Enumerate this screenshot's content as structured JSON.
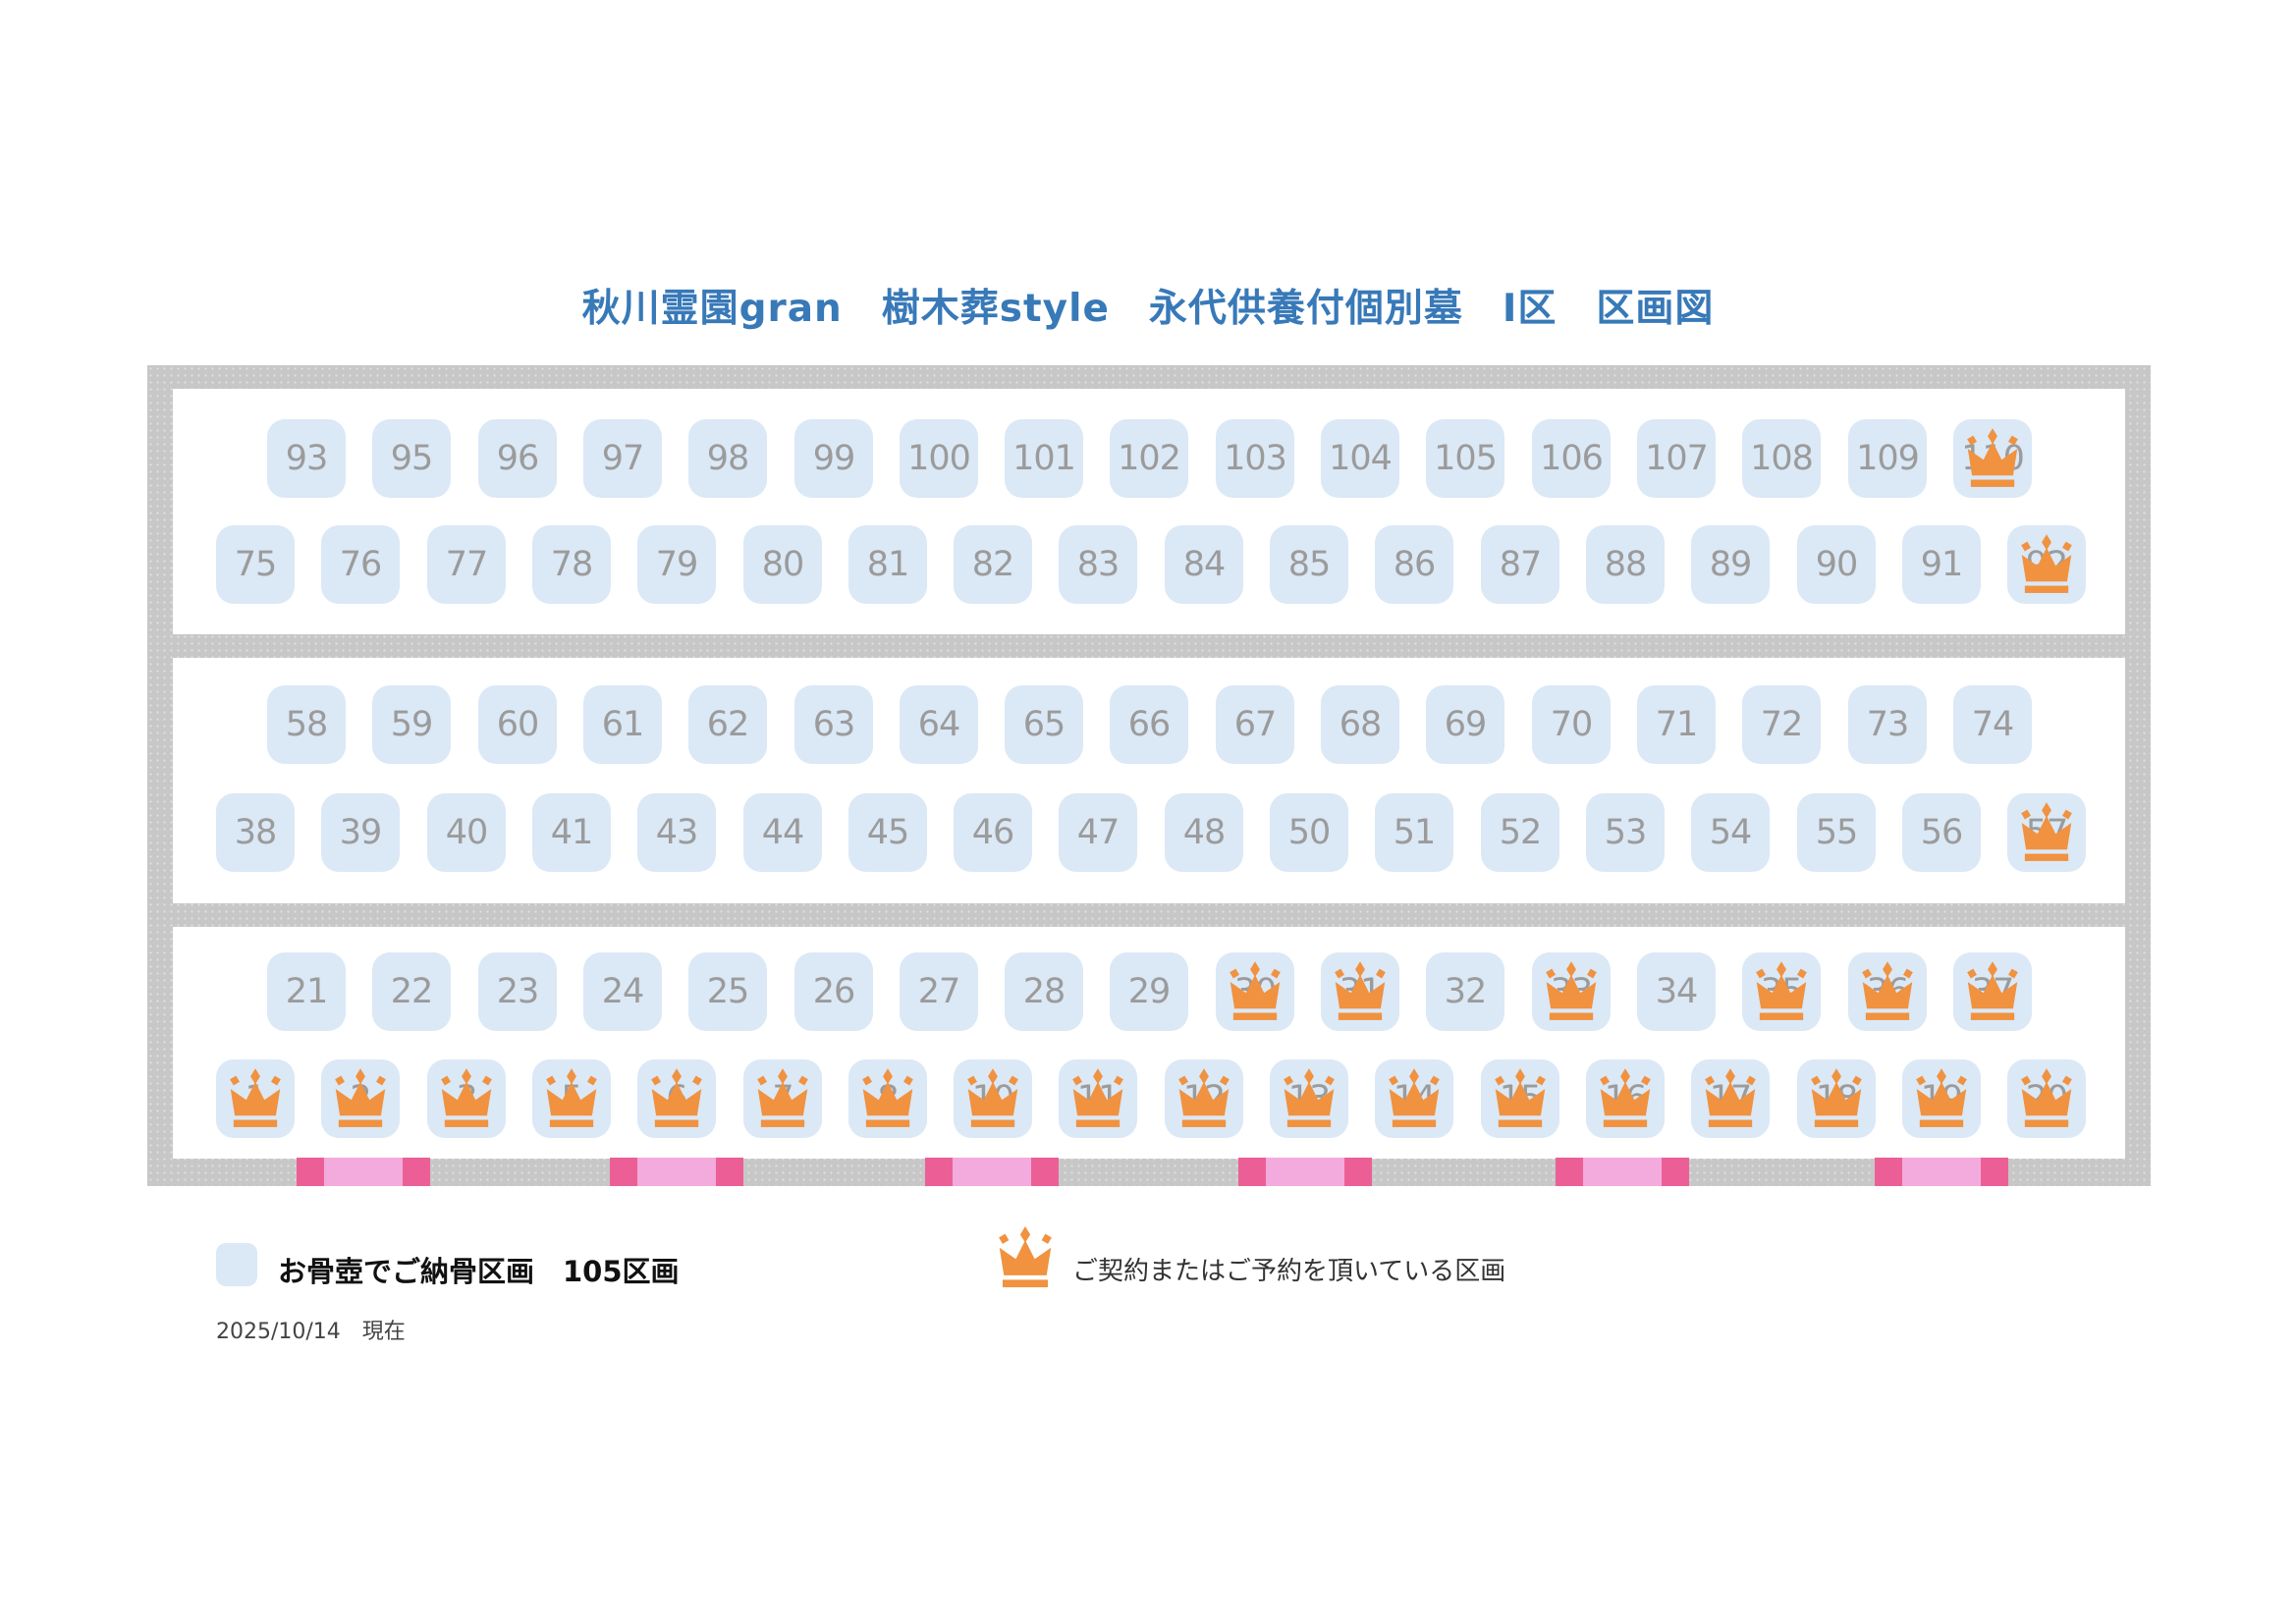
{
  "title": "秋川霊園gran　樹木葬style　永代供養付個別墓　Ⅰ区　区画図",
  "legend": {
    "urn_plot_label": "お骨壺でご納骨区画　105区画",
    "reserved_label": "ご契約またはご予約を頂いている区画",
    "plot_count": "105",
    "urn_icon": "blue-rounded-square",
    "reserved_icon": "crown"
  },
  "as_of": "2025/10/14　現在",
  "colors": {
    "title_blue": "#3879b8",
    "frame_gray": "#c7c7c7",
    "plot_fill": "#dbe8f6",
    "plot_number": "#9b9b9b",
    "crown_orange": "#f0923f",
    "pink_dark": "#ec5f96",
    "pink_light": "#f2abdc"
  },
  "sections": [
    {
      "name": "section-1",
      "rows": [
        {
          "indent": true,
          "plots": [
            {
              "n": "93",
              "reserved": false
            },
            {
              "n": "95",
              "reserved": false
            },
            {
              "n": "96",
              "reserved": false
            },
            {
              "n": "97",
              "reserved": false
            },
            {
              "n": "98",
              "reserved": false
            },
            {
              "n": "99",
              "reserved": false
            },
            {
              "n": "100",
              "reserved": false
            },
            {
              "n": "101",
              "reserved": false
            },
            {
              "n": "102",
              "reserved": false
            },
            {
              "n": "103",
              "reserved": false
            },
            {
              "n": "104",
              "reserved": false
            },
            {
              "n": "105",
              "reserved": false
            },
            {
              "n": "106",
              "reserved": false
            },
            {
              "n": "107",
              "reserved": false
            },
            {
              "n": "108",
              "reserved": false
            },
            {
              "n": "109",
              "reserved": false
            },
            {
              "n": "110",
              "reserved": true
            }
          ]
        },
        {
          "indent": false,
          "plots": [
            {
              "n": "75",
              "reserved": false
            },
            {
              "n": "76",
              "reserved": false
            },
            {
              "n": "77",
              "reserved": false
            },
            {
              "n": "78",
              "reserved": false
            },
            {
              "n": "79",
              "reserved": false
            },
            {
              "n": "80",
              "reserved": false
            },
            {
              "n": "81",
              "reserved": false
            },
            {
              "n": "82",
              "reserved": false
            },
            {
              "n": "83",
              "reserved": false
            },
            {
              "n": "84",
              "reserved": false
            },
            {
              "n": "85",
              "reserved": false
            },
            {
              "n": "86",
              "reserved": false
            },
            {
              "n": "87",
              "reserved": false
            },
            {
              "n": "88",
              "reserved": false
            },
            {
              "n": "89",
              "reserved": false
            },
            {
              "n": "90",
              "reserved": false
            },
            {
              "n": "91",
              "reserved": false
            },
            {
              "n": "92",
              "reserved": true
            }
          ]
        }
      ]
    },
    {
      "name": "section-2",
      "rows": [
        {
          "indent": true,
          "plots": [
            {
              "n": "58",
              "reserved": false
            },
            {
              "n": "59",
              "reserved": false
            },
            {
              "n": "60",
              "reserved": false
            },
            {
              "n": "61",
              "reserved": false
            },
            {
              "n": "62",
              "reserved": false
            },
            {
              "n": "63",
              "reserved": false
            },
            {
              "n": "64",
              "reserved": false
            },
            {
              "n": "65",
              "reserved": false
            },
            {
              "n": "66",
              "reserved": false
            },
            {
              "n": "67",
              "reserved": false
            },
            {
              "n": "68",
              "reserved": false
            },
            {
              "n": "69",
              "reserved": false
            },
            {
              "n": "70",
              "reserved": false
            },
            {
              "n": "71",
              "reserved": false
            },
            {
              "n": "72",
              "reserved": false
            },
            {
              "n": "73",
              "reserved": false
            },
            {
              "n": "74",
              "reserved": false
            }
          ]
        },
        {
          "indent": false,
          "plots": [
            {
              "n": "38",
              "reserved": false
            },
            {
              "n": "39",
              "reserved": false
            },
            {
              "n": "40",
              "reserved": false
            },
            {
              "n": "41",
              "reserved": false
            },
            {
              "n": "43",
              "reserved": false
            },
            {
              "n": "44",
              "reserved": false
            },
            {
              "n": "45",
              "reserved": false
            },
            {
              "n": "46",
              "reserved": false
            },
            {
              "n": "47",
              "reserved": false
            },
            {
              "n": "48",
              "reserved": false
            },
            {
              "n": "50",
              "reserved": false
            },
            {
              "n": "51",
              "reserved": false
            },
            {
              "n": "52",
              "reserved": false
            },
            {
              "n": "53",
              "reserved": false
            },
            {
              "n": "54",
              "reserved": false
            },
            {
              "n": "55",
              "reserved": false
            },
            {
              "n": "56",
              "reserved": false
            },
            {
              "n": "57",
              "reserved": true
            }
          ]
        }
      ]
    },
    {
      "name": "section-3",
      "rows": [
        {
          "indent": true,
          "plots": [
            {
              "n": "21",
              "reserved": false
            },
            {
              "n": "22",
              "reserved": false
            },
            {
              "n": "23",
              "reserved": false
            },
            {
              "n": "24",
              "reserved": false
            },
            {
              "n": "25",
              "reserved": false
            },
            {
              "n": "26",
              "reserved": false
            },
            {
              "n": "27",
              "reserved": false
            },
            {
              "n": "28",
              "reserved": false
            },
            {
              "n": "29",
              "reserved": false
            },
            {
              "n": "30",
              "reserved": true
            },
            {
              "n": "31",
              "reserved": true
            },
            {
              "n": "32",
              "reserved": false
            },
            {
              "n": "33",
              "reserved": true
            },
            {
              "n": "34",
              "reserved": false
            },
            {
              "n": "35",
              "reserved": true
            },
            {
              "n": "36",
              "reserved": true
            },
            {
              "n": "37",
              "reserved": true
            }
          ]
        },
        {
          "indent": false,
          "plots": [
            {
              "n": "1",
              "reserved": true
            },
            {
              "n": "2",
              "reserved": true
            },
            {
              "n": "3",
              "reserved": true
            },
            {
              "n": "5",
              "reserved": true
            },
            {
              "n": "6",
              "reserved": true
            },
            {
              "n": "7",
              "reserved": true
            },
            {
              "n": "8",
              "reserved": true
            },
            {
              "n": "10",
              "reserved": true
            },
            {
              "n": "11",
              "reserved": true
            },
            {
              "n": "12",
              "reserved": true
            },
            {
              "n": "13",
              "reserved": true
            },
            {
              "n": "14",
              "reserved": true
            },
            {
              "n": "15",
              "reserved": true
            },
            {
              "n": "16",
              "reserved": true
            },
            {
              "n": "17",
              "reserved": true
            },
            {
              "n": "18",
              "reserved": true
            },
            {
              "n": "19",
              "reserved": true
            },
            {
              "n": "20",
              "reserved": true
            }
          ]
        }
      ]
    }
  ]
}
